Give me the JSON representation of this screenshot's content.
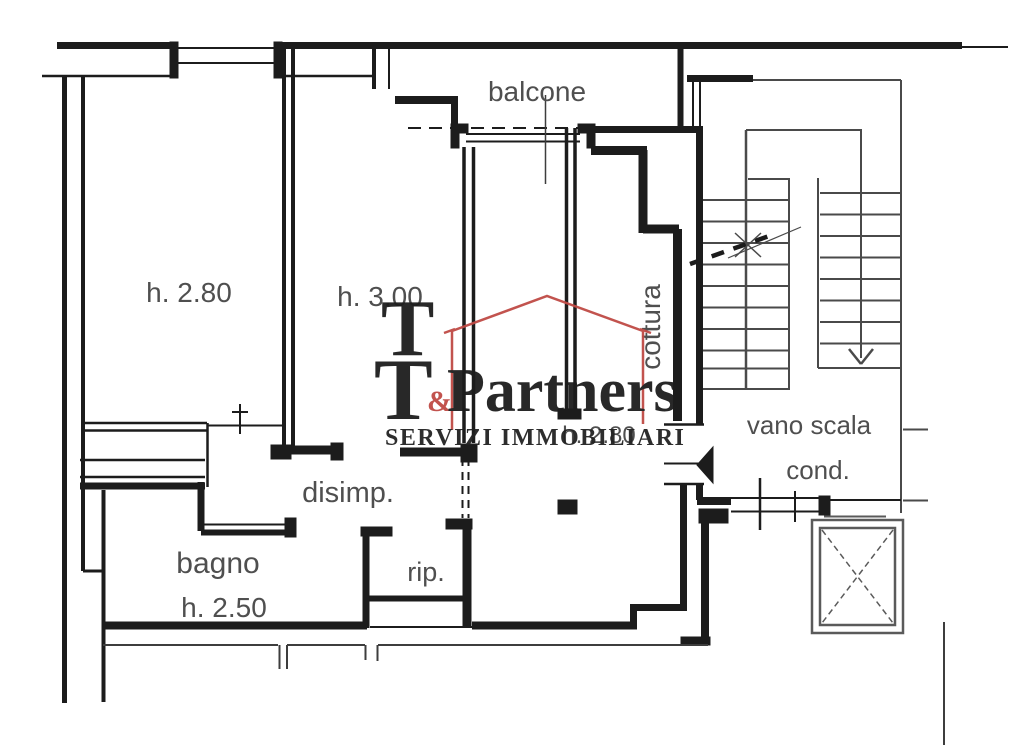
{
  "page": {
    "background": "#ffffff",
    "type": "apartment floor plan drawing"
  },
  "colors": {
    "page_bg": "#ffffff",
    "wall": "#1c1c1c",
    "thin_line": "#3d3d3d",
    "stair_line": "#4a4a4a",
    "elevator_line": "#5a5a5a",
    "label": "#4f4f4f",
    "brand_red": "#bf4a45",
    "brand_dark": "#1d1d1d"
  },
  "plan": {
    "labels": {
      "balcone": "balcone",
      "room_left_height": "h. 2.80",
      "room_mid_height": "h. 3.00",
      "cottura": "cottura",
      "disimp": "disimp.",
      "bagno": "bagno",
      "bagno_height": "h. 2.50",
      "rip": "rip.",
      "vano_scala": "vano scala",
      "cond": "cond.",
      "living_height": "h. 2.80"
    }
  },
  "watermark": {
    "logo_t_top": "T",
    "logo_t_bottom": "T",
    "ampersand": "&",
    "name": "Partners",
    "subtitle": "SERVIZI IMMOBILIARI"
  }
}
